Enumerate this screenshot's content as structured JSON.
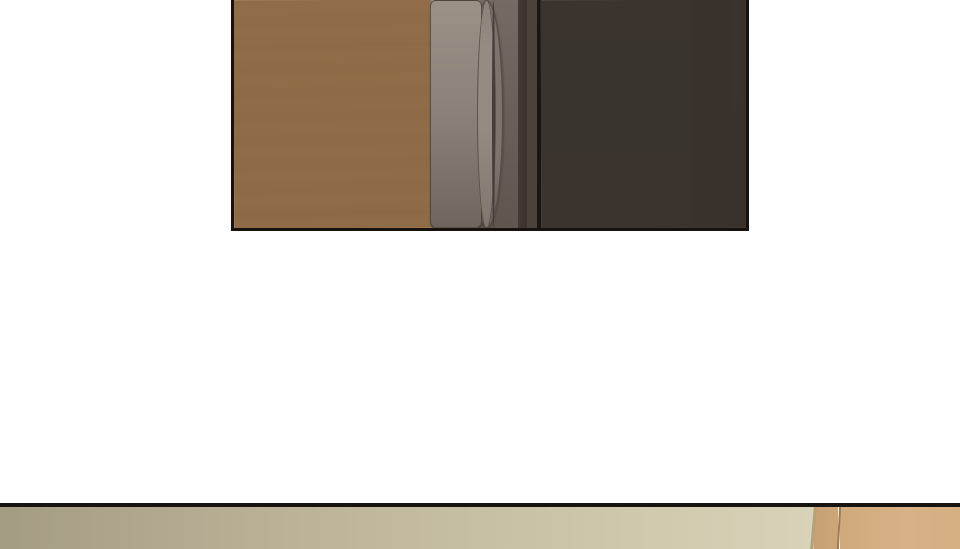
{
  "page": {
    "kind": "webtoon comic page segment",
    "background": "#ffffff"
  },
  "panels": [
    {
      "id": "panel-door-closeup",
      "description": "close-up of a closed dark door with a metal lever handle, light wood-panel wall on the left",
      "objects": [
        "wood-wall",
        "wall-seam",
        "door-frame-strip",
        "door-stile",
        "door-handle",
        "door-edge",
        "door-face",
        "door-face-seam"
      ]
    },
    {
      "id": "panel-room-top",
      "description": "top sliver of the next panel: beige room wall with a light wood door edge at the right"
    }
  ],
  "colors": {
    "page_bg": "#ffffff",
    "panel_border": "#17120e",
    "wood_wall": "#ac845b",
    "wood_seam": "#8a6743",
    "frame_strip": "#98908a",
    "stile_top": "#746b64",
    "stile_bottom": "#5f564f",
    "handle_metal": "#8a8178",
    "rose_metal": "#7d746d",
    "door_edge_dark": "#423b35",
    "door_edge_mid": "#4a423b",
    "door_black_line": "#1a1512",
    "door_panel": "#4c443d",
    "door_seam": "#39322c",
    "divider_line": "#161310",
    "wall_left": "#a49b83",
    "wall_right": "#d8d2b8",
    "wall_edge_line": "#b3a17a",
    "wood2_left": "#c79f72",
    "wood2_line": "#a07a4c",
    "wood2_right": "#d8b286"
  }
}
